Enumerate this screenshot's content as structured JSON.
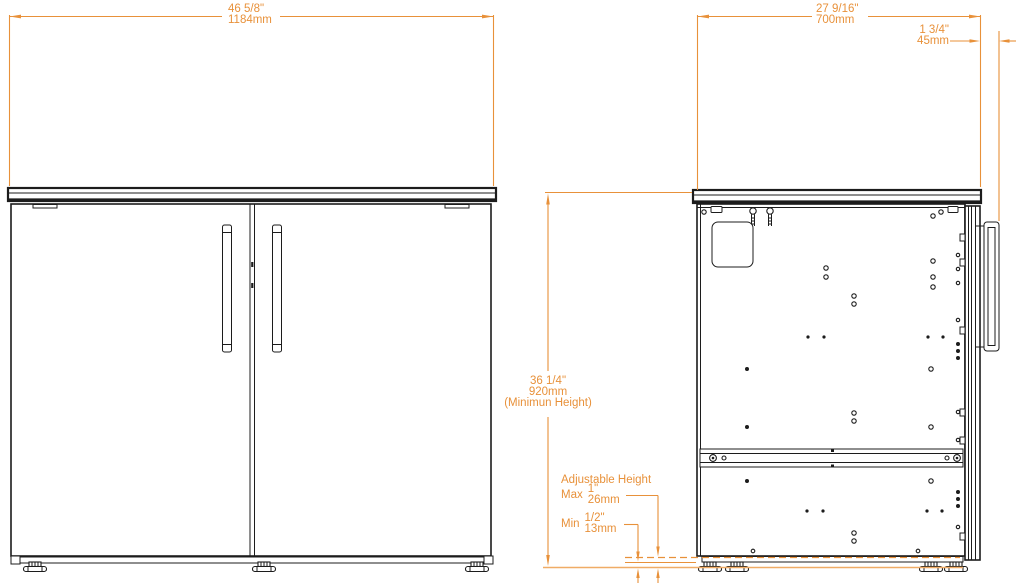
{
  "colors": {
    "dimension_accent": "#E8913A",
    "drawing_line": "#1C1C1C",
    "background": "#FFFFFF"
  },
  "dimensions": {
    "width": {
      "inches": "46 5/8\"",
      "mm": "1184mm"
    },
    "depth": {
      "inches": "27 9/16\"",
      "mm": "700mm"
    },
    "front_offset": {
      "inches": "1 3/4\"",
      "mm": "45mm"
    },
    "height": {
      "inches": "36 1/4\"",
      "mm": "920mm",
      "note": "(Minimun Height)"
    },
    "adjustable": {
      "title": "Adjustable Height",
      "max": {
        "label": "Max",
        "inches": "1\"",
        "mm": "26mm"
      },
      "min": {
        "label": "Min",
        "inches": "1/2\"",
        "mm": "13mm"
      }
    }
  }
}
